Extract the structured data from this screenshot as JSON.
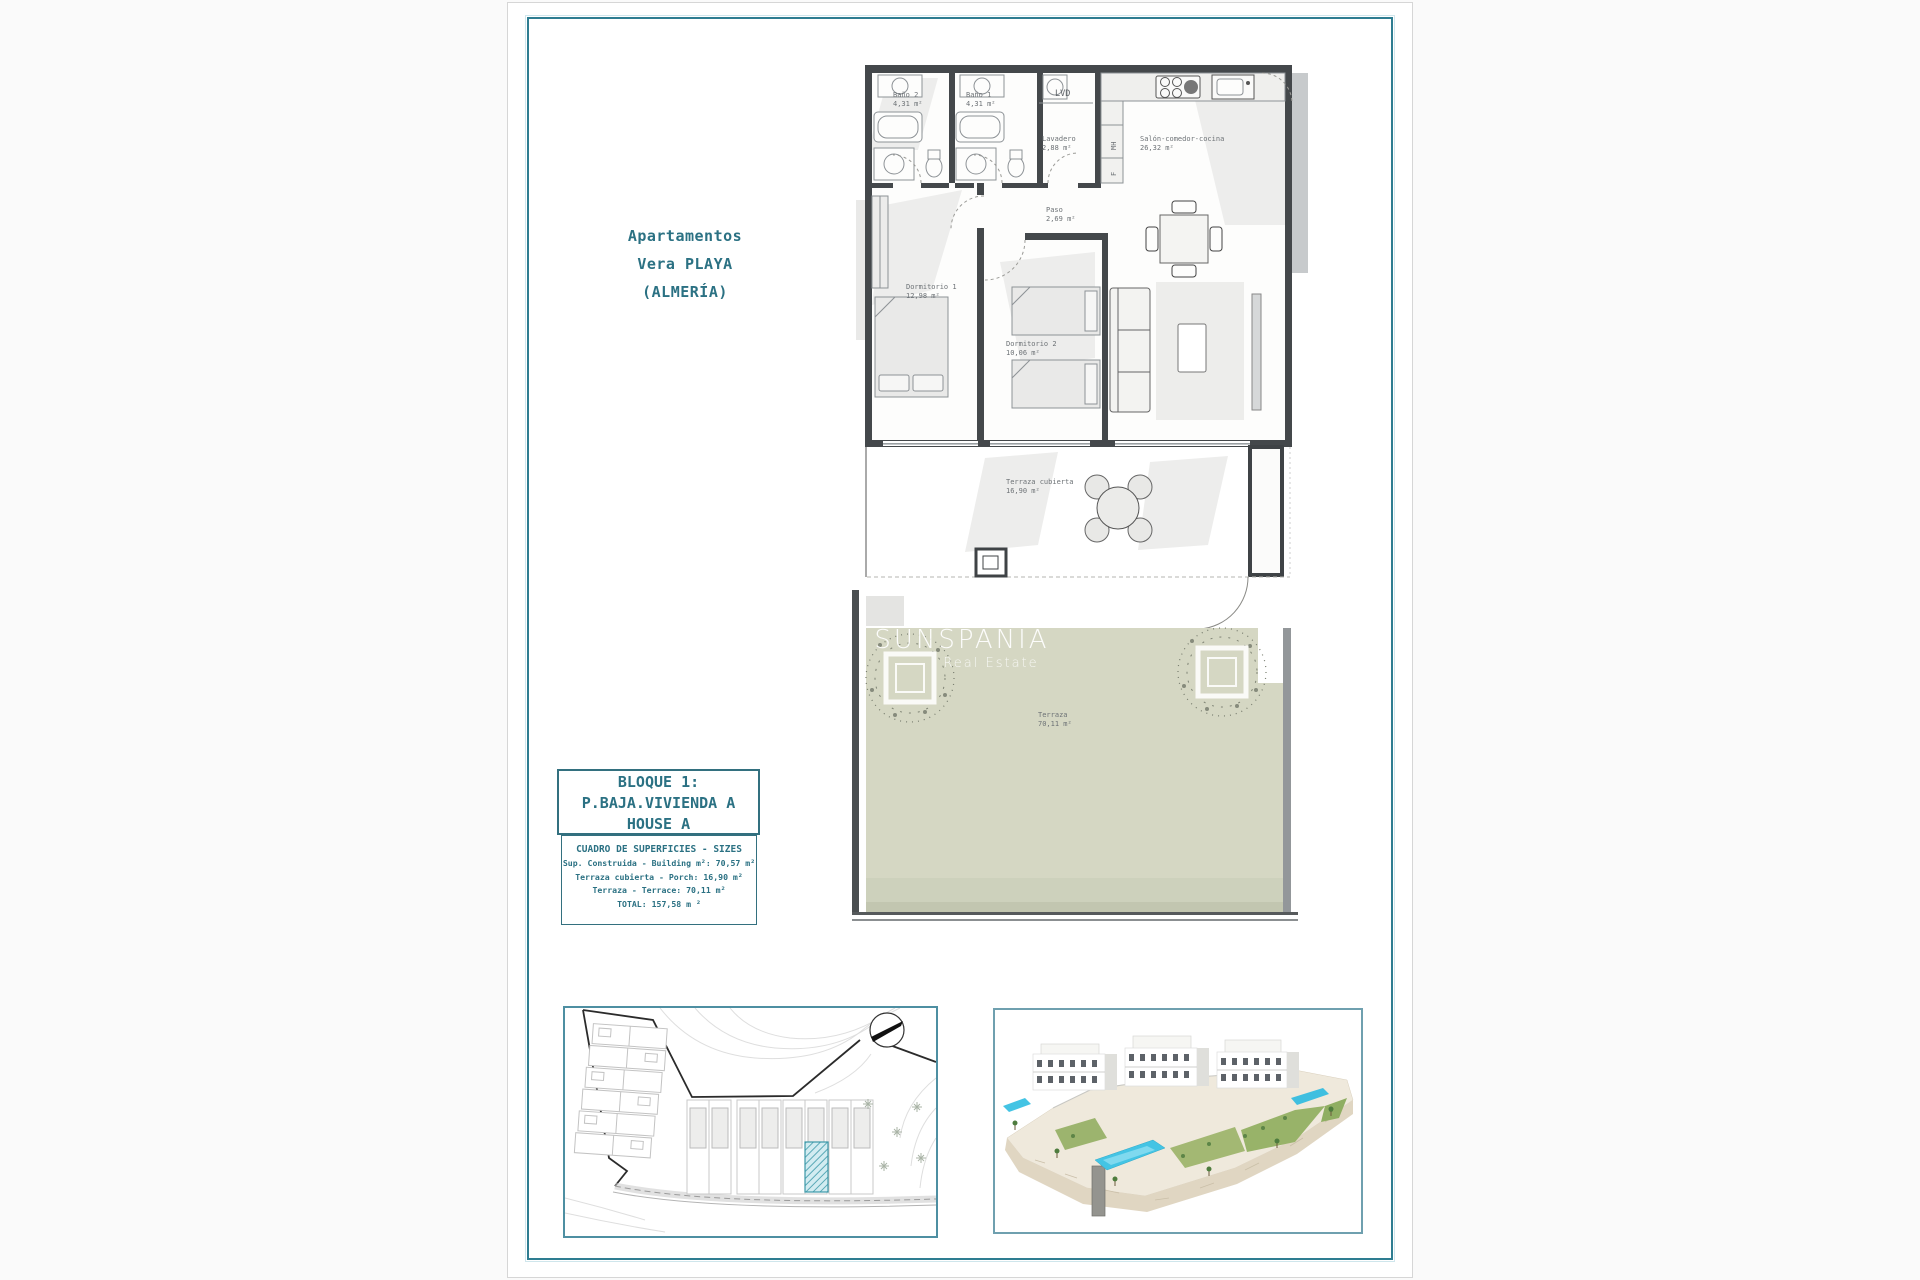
{
  "document": {
    "project_title_lines": [
      "Apartamentos",
      "Vera PLAYA",
      "(ALMERÍA)"
    ],
    "watermark": {
      "brand": "SUNSPANIA",
      "tagline": "Real Estate"
    }
  },
  "floor_plan": {
    "rooms": [
      {
        "name": "Baño 2",
        "area": "4,31 m²"
      },
      {
        "name": "Baño 1",
        "area": "4,31 m²"
      },
      {
        "name": "LVD"
      },
      {
        "name": "Lavadero",
        "area": "2,88 m²"
      },
      {
        "name": "Salón-comedor-cocina",
        "area": "26,32 m²"
      },
      {
        "name": "Paso",
        "area": "2,69 m²"
      },
      {
        "name": "Dormitorio 1",
        "area": "12,98 m²"
      },
      {
        "name": "Dormitorio 2",
        "area": "10,06 m²"
      },
      {
        "name": "Terraza cubierta",
        "area": "16,90 m²"
      },
      {
        "name": "Terraza",
        "area": "70,11 m²"
      }
    ],
    "fixture_labels": {
      "tall_unit": "MH",
      "fridge": "F"
    }
  },
  "unit_info_box": {
    "lines": [
      "BLOQUE 1:",
      "P.BAJA.VIVIENDA A",
      "HOUSE A"
    ]
  },
  "sizes_box": {
    "header": "CUADRO DE SUPERFICIES - SIZES",
    "rows": [
      "Sup. Construida - Building m²: 70,57 m²",
      "Terraza cubierta - Porch: 16,90 m²",
      "Terraza - Terrace: 70,11 m²",
      "TOTAL: 157,58 m ²"
    ]
  },
  "colors": {
    "accent_teal": "#2e7d91",
    "text_teal": "#2b7183",
    "terrace_green": "#d5d7c3",
    "wall_dark": "#44484b",
    "site_hatch_fill": "#d2ecf1",
    "site_hatch_line": "#3b98a8",
    "pool_blue": "#44c4e4"
  }
}
